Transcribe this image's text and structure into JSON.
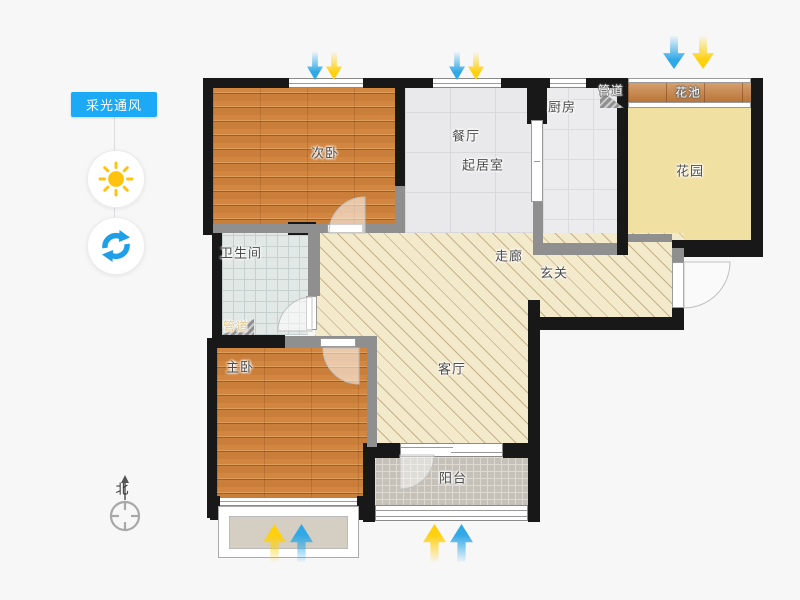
{
  "sidebar": {
    "tool_label": "采光通风",
    "sun_icon": "sun-icon",
    "rotate_icon": "rotate-refresh-icon"
  },
  "compass": {
    "north_label": "北"
  },
  "rooms": {
    "ciwo": {
      "label": "次卧"
    },
    "canting": {
      "label": "餐厅"
    },
    "qijushi": {
      "label": "起居室"
    },
    "chufang": {
      "label": "厨房"
    },
    "guandao_top": {
      "label": "管道"
    },
    "huachi": {
      "label": "花池"
    },
    "huayuan": {
      "label": "花园"
    },
    "weishengjian": {
      "label": "卫生间"
    },
    "zoulang": {
      "label": "走廊"
    },
    "xuanguan": {
      "label": "玄关"
    },
    "guandao_bottom": {
      "label": "管道"
    },
    "zhuwo": {
      "label": "主卧"
    },
    "keting": {
      "label": "客厅"
    },
    "yangtai": {
      "label": "阳台"
    }
  },
  "colors": {
    "accent_blue": "#1ca9f5",
    "sun_yellow": "#ffc20e",
    "arrow_blue": "#2fa8e6",
    "arrow_yellow": "#ffd00e",
    "wood_floor": "#d3863f",
    "garden_yellow": "#f0e0a2",
    "hatch_cream": "#f3e9cb"
  }
}
